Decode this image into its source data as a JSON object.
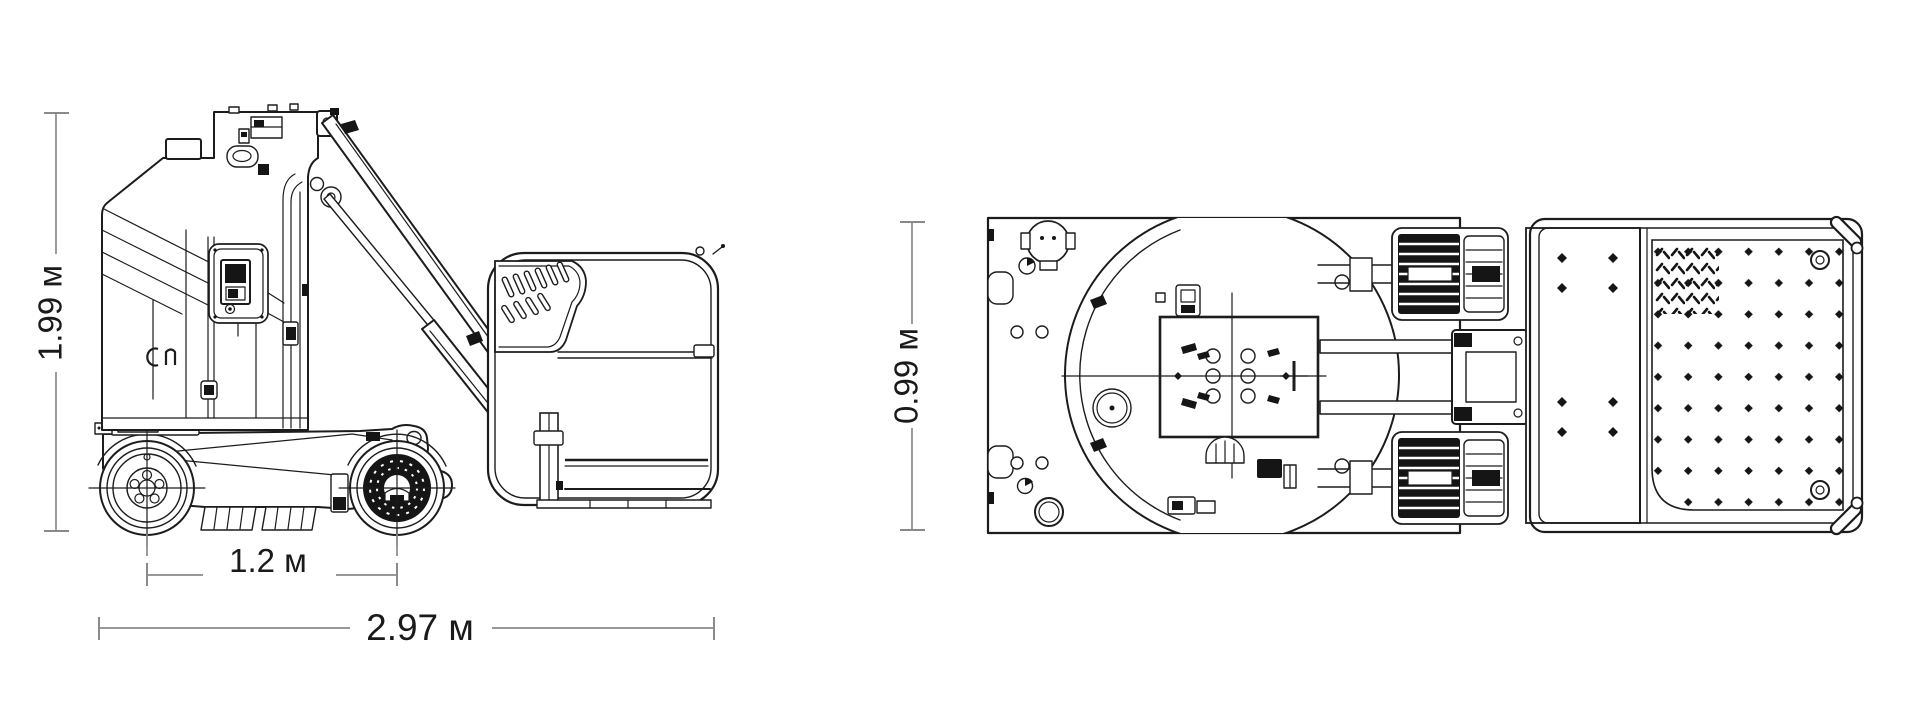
{
  "page": {
    "background": "#ffffff"
  },
  "drawing": {
    "type": "technical dimensional drawing",
    "line_color": "#1c1c1c",
    "dimension_line_color": "#8a8a8a",
    "label_color": "#1a1a1a",
    "views": {
      "side": {
        "name": "side-view",
        "dimensions": {
          "height": {
            "label": "1.99 м",
            "value": 1.99,
            "unit": "м",
            "orientation": "vertical"
          },
          "wheelbase": {
            "label": "1.2 м",
            "value": 1.2,
            "unit": "м",
            "orientation": "horizontal"
          },
          "length": {
            "label": "2.97 м",
            "value": 2.97,
            "unit": "м",
            "orientation": "horizontal"
          }
        }
      },
      "top": {
        "name": "top-view",
        "dimensions": {
          "width": {
            "label": "0.99 м",
            "value": 0.99,
            "unit": "м",
            "orientation": "vertical"
          }
        }
      }
    }
  }
}
